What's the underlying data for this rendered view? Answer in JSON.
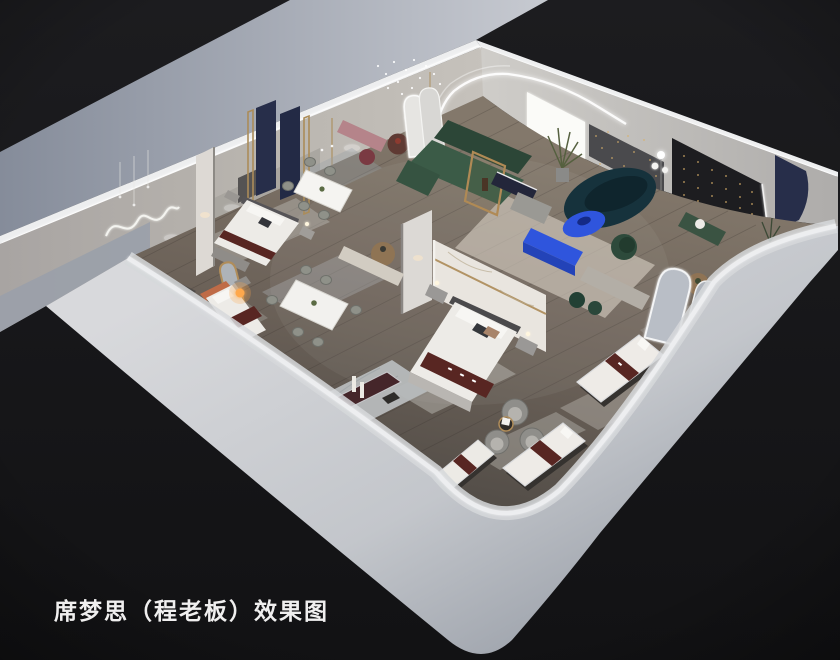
{
  "caption": {
    "text": "席梦思（程老板）效果图",
    "color": "#f0efef"
  },
  "palette": {
    "background_top": "#1c1c1f",
    "background_bottom": "#121214",
    "exterior_band_left": "#858c9a",
    "exterior_band_right": "#c7cad1",
    "wall_top_strip": "#edeeef",
    "back_wall_face": "#b5b1ab",
    "front_wall_light": "#cfd2d6",
    "front_wall_dark": "#9298a2",
    "floor_light": "#83786b",
    "floor_dark": "#4f4a45",
    "rug_gray": "#b6b3ae",
    "rug_cream": "#d8d1c4",
    "bed_linen": "#edebe7",
    "runner_maroon": "#582622",
    "mattress_base": "#35322f",
    "sofa_green": "#3b5b47",
    "sofa_green_dark": "#2c4637",
    "sofa_teal": "#16323c",
    "cobalt_blue": "#2f55dd",
    "accent_pink": "#b5848a",
    "burgundy": "#7a3a42",
    "navy_panel": "#272e4a",
    "feature_wall_black": "#1d1d20",
    "brass": "#ab8c59",
    "string_light_gold": "#d9b06a",
    "lamp_orange": "#ffa94d",
    "marble": "#e9e5df",
    "terracotta": "#bf6b47"
  },
  "scene_objects": [
    "exterior ground band",
    "back wall with neon squiggle art and pendant lights",
    "back wall with LED arch, lit panel and string-light feature walls",
    "wood showroom floor with area rugs",
    "three bedroom displays with branded maroon bed runners",
    "two dining sets with marble tables",
    "lounge with green sectional, curved teal sofa, cobalt tables",
    "mattress displays with maroon brand bands",
    "arched mirror displays",
    "marble display platform with candles",
    "swivel barrel chairs with gold side table",
    "front exterior walls with rounded corner"
  ]
}
